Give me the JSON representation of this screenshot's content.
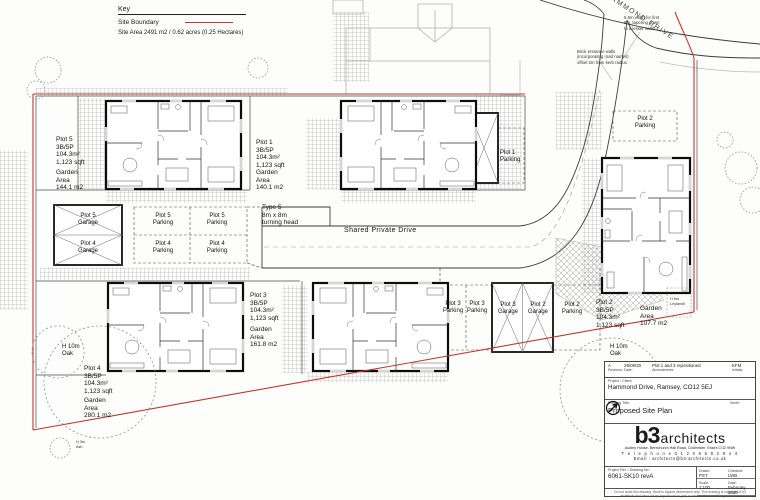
{
  "colors": {
    "site_boundary": "#c0392b"
  },
  "key": {
    "title": "Key",
    "site_boundary": "Site Boundary",
    "site_area": "Site Area 2491 m2 /  0.62 acres (0.25 Hectares)"
  },
  "roads": {
    "hammond_drive": "HAMMOND DRIVE",
    "shared_private_drive": "Shared Private Drive",
    "turning_head": "Type 5\n8m x 8m\nturning head",
    "width_note": "5.5m width for first\n8m, tapering down\nto a lesser width",
    "entrance_note": "Brick entrance walls\n(incorporating road names)\noffset 2m from kerb radius"
  },
  "plots": {
    "plot5": {
      "info": "Plot 5\n3B/5P\n104.3m²\n1,123 sqft",
      "garden": "Garden\nArea\n144.1 m2"
    },
    "plot1": {
      "info": "Plot 1\n3B/5P\n104.3m²\n1,123 sqft",
      "garden": "Garden\nArea\n140.1 m2"
    },
    "plot4": {
      "info": "Plot 4\n3B/5P\n104.3m²\n1,123 sqft",
      "garden": "Garden\nArea\n280.1 m2"
    },
    "plot3": {
      "info": "Plot 3\n3B/5P\n104.3m²\n1,123 sqft",
      "garden": "Garden\nArea\n161.8 m2"
    },
    "plot2": {
      "info": "Plot 2\n3B/5P\n104.3m²\n1,123 sqft",
      "garden": "Garden\nArea\n107.7 m2"
    }
  },
  "parking": {
    "p5_garage": "Plot 5\nGarage",
    "p4_garage": "Plot 4\nGarage",
    "p5_parking_a": "Plot 5\nParking",
    "p5_parking_b": "Plot 5\nParking",
    "p4_parking_a": "Plot 4\nParking",
    "p4_parking_b": "Plot 4\nParking",
    "p3_parking_a": "Plot 3\nParking",
    "p3_parking_b": "Plot 3\nParking",
    "p3_garage": "Plot 3\nGarage",
    "p2_garage": "Plot 2\nGarage",
    "p2_parking": "Plot 2\nParking",
    "p2_parking_top": "Plot 2\nParking",
    "p1_parking": "Plot 1\nParking"
  },
  "landscape": {
    "oak_left": "H 10m\nOak",
    "oak_right": "H 10m\nOak",
    "leylandii": "H 6m\nLeylandii",
    "ash": "H 3m\nAsh"
  },
  "titleblock": {
    "revision": {
      "rev": "A",
      "rev_label": "Revision:",
      "date": "29/09/20",
      "date_label": "Date:",
      "desc": "Plot 1 and 3 repositioned",
      "desc_label": "Amendments:",
      "initials": "KFM",
      "initials_label": "Initials:"
    },
    "project_label": "Project / Client:",
    "project": "Hammond Drive, Ramsey, CO12 5EJ",
    "drawing_title_label": "Drawing Title:",
    "drawing_title": "Proposed Site Plan",
    "north_label": "North:",
    "firm": {
      "name_b3": "b3",
      "name_rest": "architects",
      "address": "Audley House, Berechurch Hall Road, Colchester, Essex CO2 9NW",
      "phone": "T e l e p h o n e   0 1 2 0 6   5 8 2 9 4 4",
      "email": "Email : architects@b3-architects.co.uk"
    },
    "ref_label": "Project Ref. / Drawing No.:",
    "ref": "6061-SK10 revA",
    "drawn_label": "Drawn:",
    "drawn": "PST",
    "checked_label": "Checked:",
    "checked": "LWB",
    "scale_label": "Scale:",
    "scale": "1:100",
    "date_label": "Date:",
    "date": "February 2020",
    "disclaimer": "Do not scale this drawing. Work to figured dimensions only. This drawing is copyright of b3 architects and must not be reproduced in part or whole without written permission."
  }
}
